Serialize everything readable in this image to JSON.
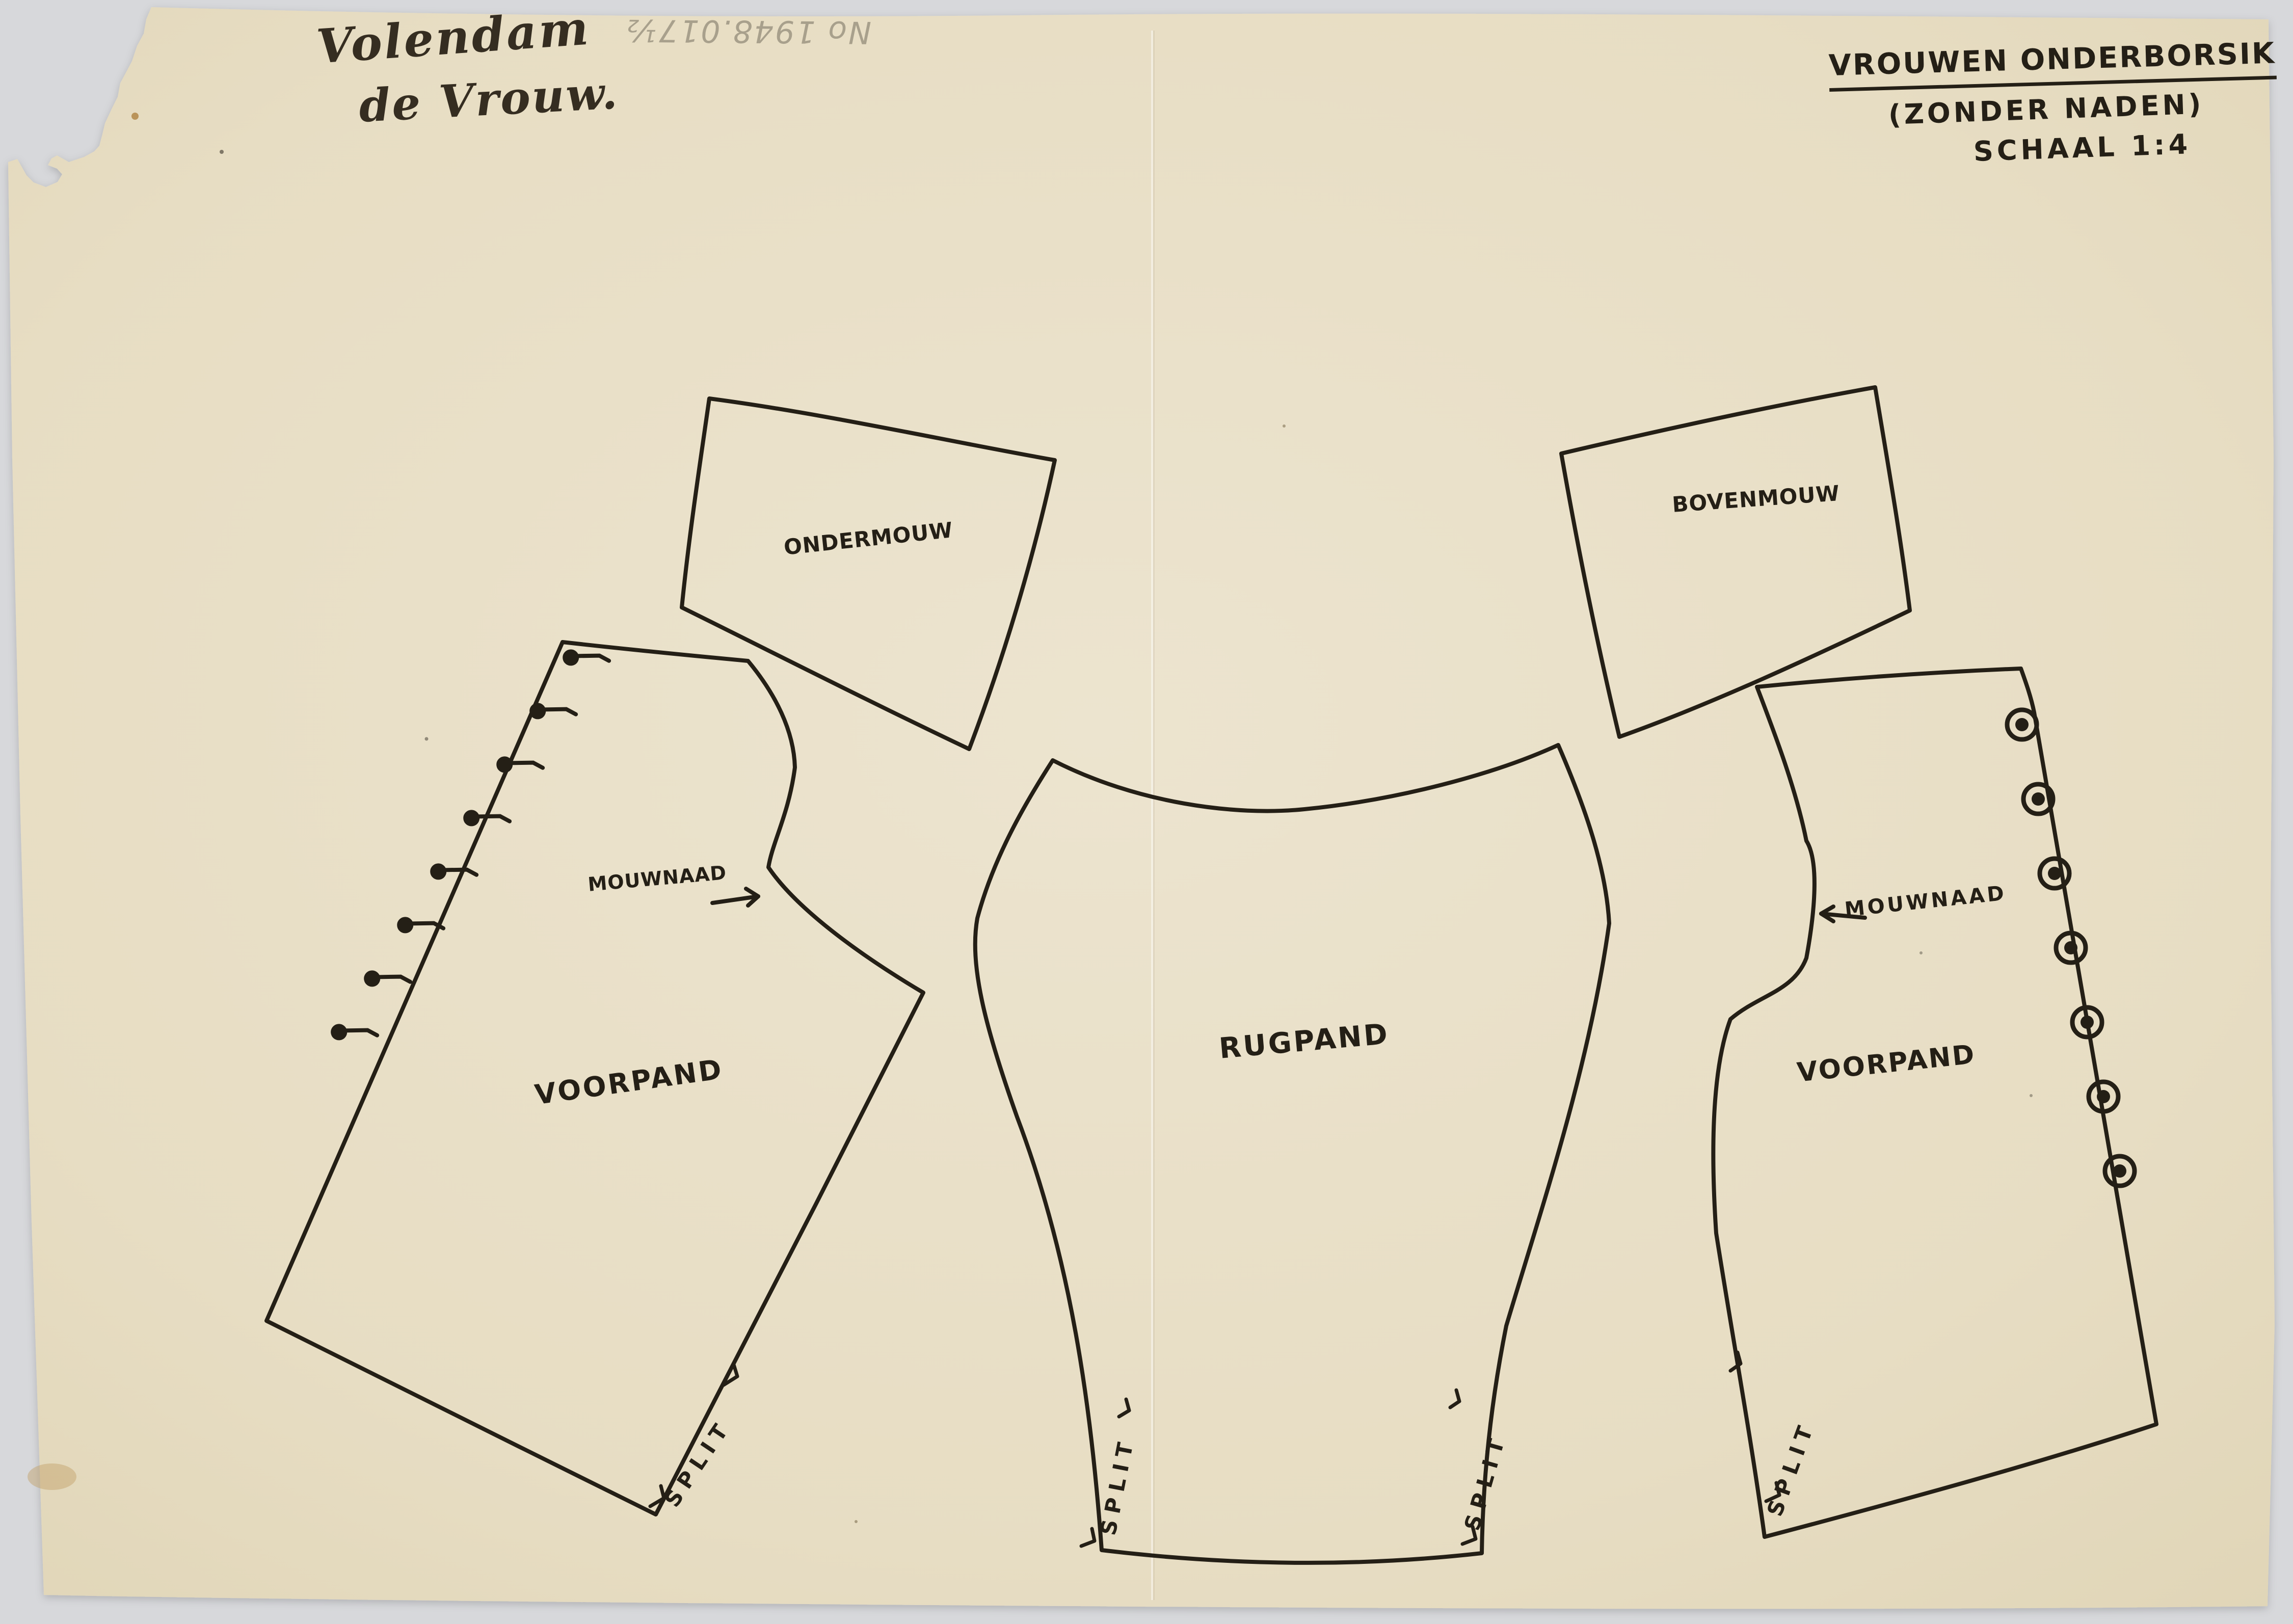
{
  "page": {
    "background_color": "#d7d8db",
    "paper_color": "#e8dfc6",
    "ink_color": "#241f16",
    "pencil_color": "#99917f"
  },
  "annotations": {
    "handwritten_note_line1": "Volendam",
    "handwritten_note_line2": "de Vrouw.",
    "pencil_inventory_note": "No 1948.017½",
    "title_line1": "VROUWEN ONDERBORSIK",
    "title_line2": "(ZONDER NADEN)",
    "title_line3": "SCHAAL 1:4"
  },
  "pieces": {
    "ondermouw": {
      "label": "ONDERMOUW"
    },
    "bovenmouw": {
      "label": "BOVENMOUW"
    },
    "voorpand_left": {
      "label": "VOORPAND",
      "seam": "MOUWNAAD",
      "split": "SPLIT",
      "fastener_type": "hooks",
      "fastener_count": 8
    },
    "rugpand": {
      "label": "RUGPAND",
      "split_left": "SPLIT",
      "split_right": "SPLIT"
    },
    "voorpand_right": {
      "label": "VOORPAND",
      "seam": "MOUWNAAD",
      "split": "SPLIT",
      "fastener_type": "buttons",
      "fastener_count": 7
    }
  }
}
